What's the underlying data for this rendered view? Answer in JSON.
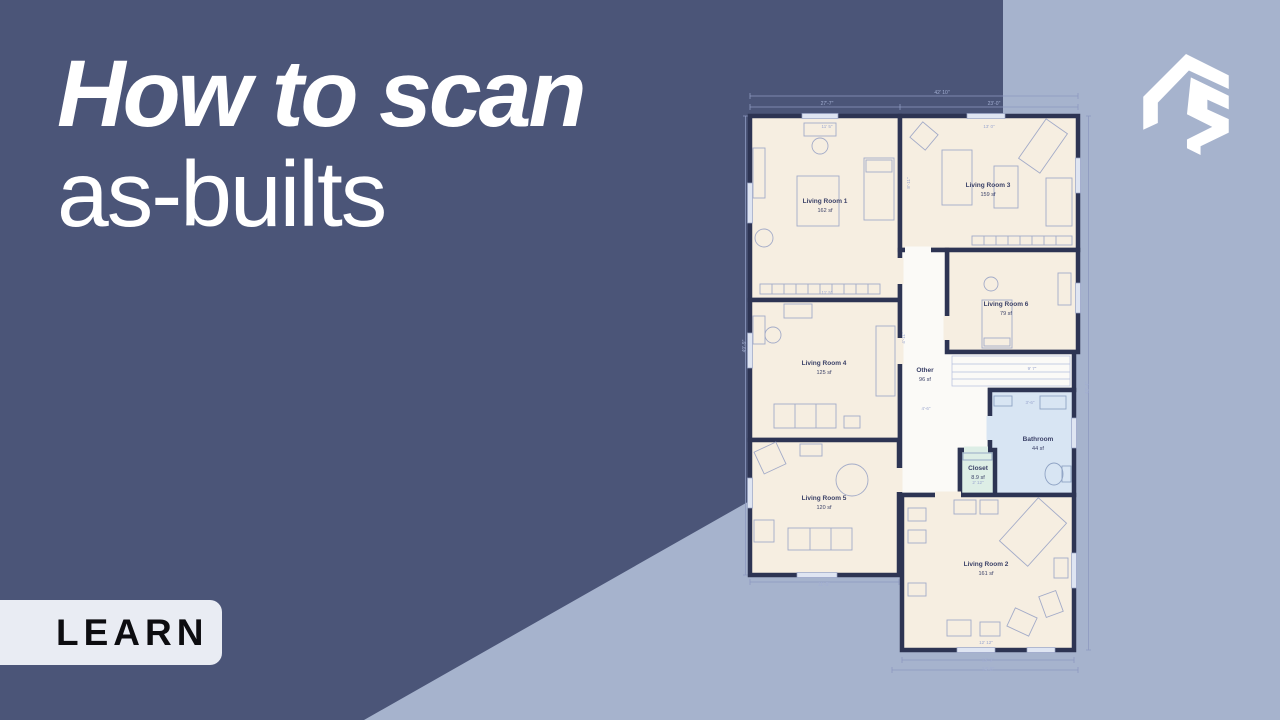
{
  "title": {
    "line1": "How to scan",
    "line2": "as-builts"
  },
  "badge": {
    "label": "LEARN"
  },
  "brand": {
    "logo_icon": "angular-r-logo",
    "logo_color": "#ffffff"
  },
  "colors": {
    "background_dark": "#4b5578",
    "background_light": "#a6b3cd",
    "badge_bg": "#e9ecf3",
    "badge_text": "#0d0d10",
    "title_text": "#ffffff",
    "plan_wall": "#2d3453",
    "plan_room_fill": "#f6eee1",
    "plan_corridor_fill": "#fbfaf7",
    "plan_bathroom_fill": "#d8e5f3",
    "plan_closet_fill": "#ddeee6"
  },
  "floor_plan": {
    "rooms": [
      {
        "name": "Living Room 1",
        "area": "162 sf",
        "x": 83,
        "y": 115
      },
      {
        "name": "Living Room 3",
        "area": "159 sf",
        "x": 246,
        "y": 99
      },
      {
        "name": "Living Room 6",
        "area": "79 sf",
        "x": 264,
        "y": 218
      },
      {
        "name": "Living Room 4",
        "area": "125 sf",
        "x": 82,
        "y": 277
      },
      {
        "name": "Other",
        "area": "96 sf",
        "x": 183,
        "y": 284
      },
      {
        "name": "Living Room 5",
        "area": "120 sf",
        "x": 82,
        "y": 412
      },
      {
        "name": "Bathroom",
        "area": "44 sf",
        "x": 296,
        "y": 353
      },
      {
        "name": "Closet",
        "area": "8.9 sf",
        "x": 236,
        "y": 382
      },
      {
        "name": "Living Room 2",
        "area": "161 sf",
        "x": 244,
        "y": 478
      }
    ],
    "dimensions": [
      {
        "text": "42' 10\"",
        "x": 200,
        "y": 6,
        "rot": 0,
        "outside": true
      },
      {
        "text": "27'-7\"",
        "x": 85,
        "y": 17,
        "rot": 0,
        "outside": true
      },
      {
        "text": "23'-0\"",
        "x": 252,
        "y": 17,
        "rot": 0,
        "outside": true
      },
      {
        "text": "49'-9\"",
        "x": 4,
        "y": 258,
        "rot": -90,
        "outside": true
      },
      {
        "text": "43'-4\"",
        "x": 347,
        "y": 300,
        "rot": -90,
        "outside": true
      },
      {
        "text": "13'-2\"",
        "x": 246,
        "y": 574,
        "rot": 0,
        "outside": true
      },
      {
        "text": "14'-8\"",
        "x": 246,
        "y": 583,
        "rot": 0,
        "outside": true
      },
      {
        "text": "11'-5\"",
        "x": 82,
        "y": 498,
        "rot": 0,
        "outside": true
      },
      {
        "text": "11' 5\"",
        "x": 85,
        "y": 40,
        "rot": 0,
        "outside": false
      },
      {
        "text": "13' 0\"",
        "x": 247,
        "y": 40,
        "rot": 0,
        "outside": false
      },
      {
        "text": "11' 5\"",
        "x": 85,
        "y": 206,
        "rot": 0,
        "outside": false
      },
      {
        "text": "8'-11\"",
        "x": 168,
        "y": 95,
        "rot": -90,
        "outside": false
      },
      {
        "text": "4'-11\"",
        "x": 163,
        "y": 250,
        "rot": -90,
        "outside": false
      },
      {
        "text": "4'-6\"",
        "x": 184,
        "y": 322,
        "rot": 0,
        "outside": false
      },
      {
        "text": "9' 7\"",
        "x": 290,
        "y": 282,
        "rot": 0,
        "outside": false
      },
      {
        "text": "3'-6\"",
        "x": 288,
        "y": 316,
        "rot": 0,
        "outside": false
      },
      {
        "text": "2' 12\"",
        "x": 236,
        "y": 396,
        "rot": 0,
        "outside": false
      },
      {
        "text": "12' 12\"",
        "x": 244,
        "y": 556,
        "rot": 0,
        "outside": false
      }
    ]
  }
}
